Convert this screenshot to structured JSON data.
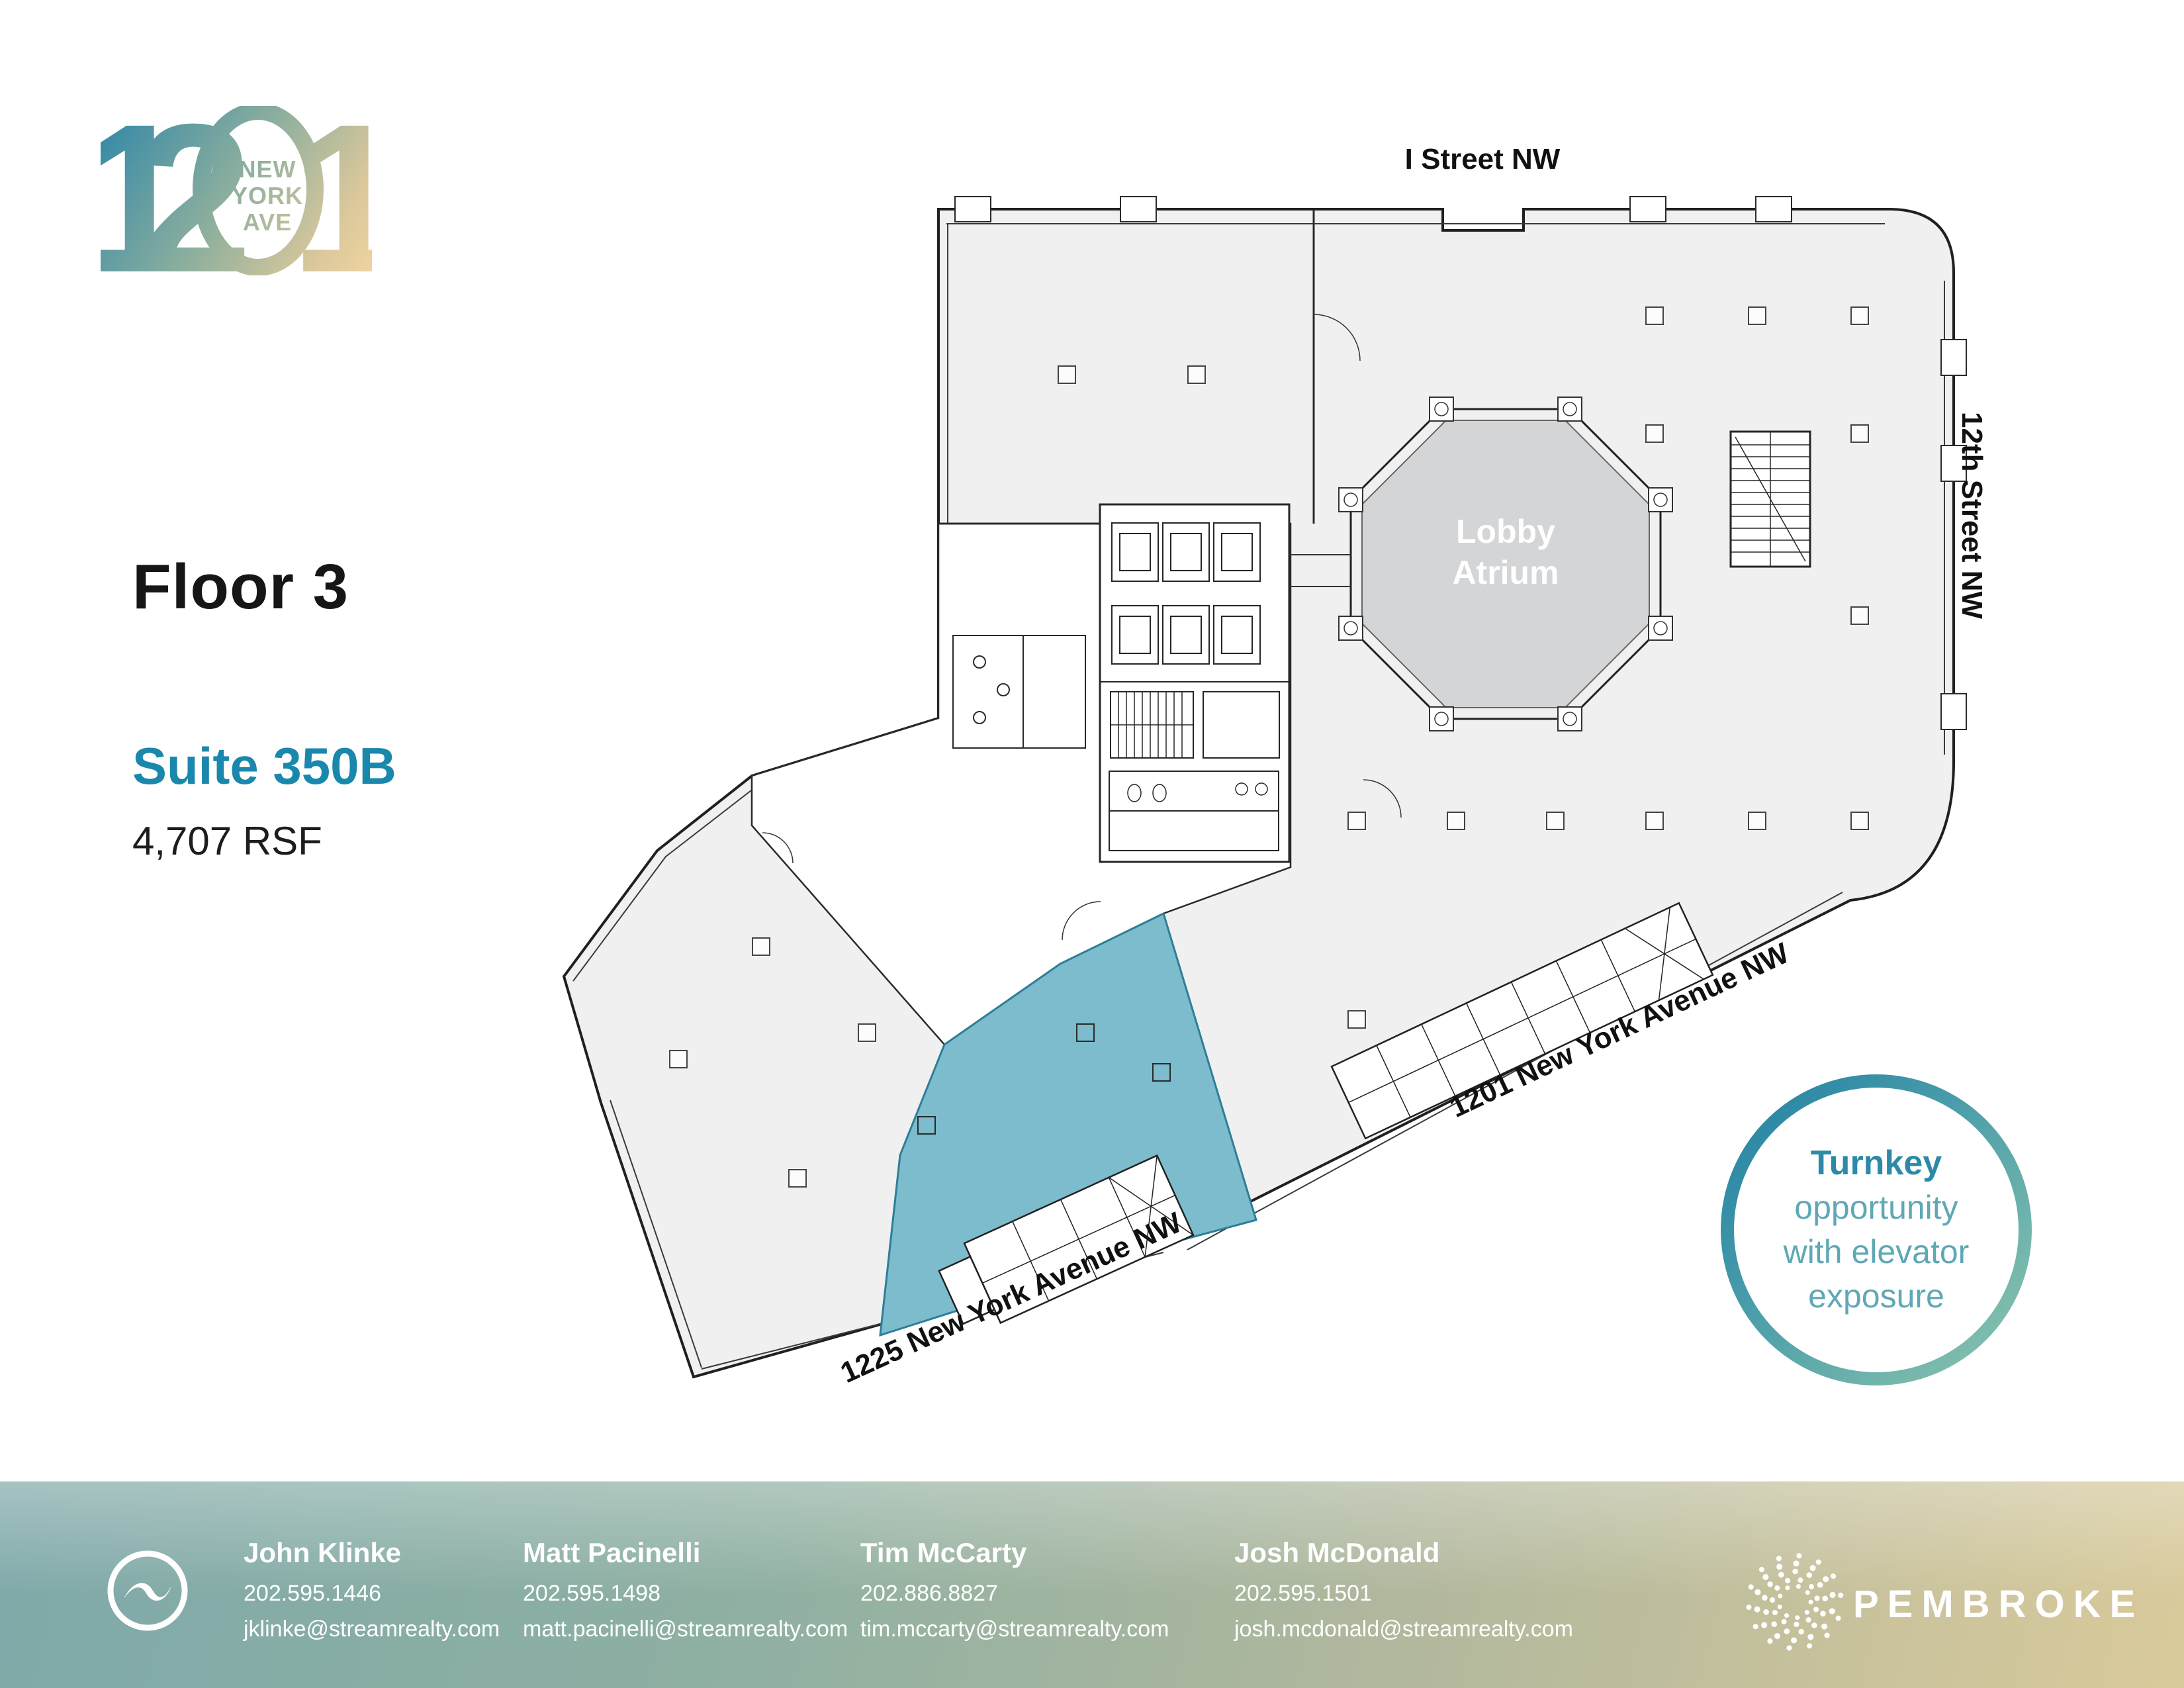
{
  "logo": {
    "digit_1a": "1",
    "digit_2": "2",
    "digit_1b": "1",
    "inner_line1": "NEW",
    "inner_line2": "YORK",
    "inner_line3": "AVE"
  },
  "left_panel": {
    "floor_title": "Floor 3",
    "suite_label": "Suite 350B",
    "area_label": "4,707 RSF"
  },
  "plan": {
    "street_top": "I Street NW",
    "street_right": "12th Street NW",
    "avenue_main": "1201 New York Avenue NW",
    "avenue_secondary": "1225 New York Avenue NW",
    "atrium_line1": "Lobby",
    "atrium_line2": "Atrium"
  },
  "badge": {
    "line1": "Turnkey",
    "line2": "opportunity",
    "line3": "with elevator",
    "line4": "exposure"
  },
  "footer": {
    "contacts": [
      {
        "name": "John Klinke",
        "phone": "202.595.1446",
        "email": "jklinke@streamrealty.com"
      },
      {
        "name": "Matt Pacinelli",
        "phone": "202.595.1498",
        "email": "matt.pacinelli@streamrealty.com"
      },
      {
        "name": "Tim McCarty",
        "phone": "202.886.8827",
        "email": "tim.mccarty@streamrealty.com"
      },
      {
        "name": "Josh McDonald",
        "phone": "202.595.1501",
        "email": "josh.mcdonald@streamrealty.com"
      }
    ],
    "brand": "PEMBROKE"
  },
  "colors": {
    "suite_highlight": "#7cbccd",
    "suite_outline": "#2d7e98",
    "suite_text_accent": "#1a87ac",
    "atrium_fill": "#d3d5d7",
    "plan_fill": "#f0f0f1",
    "badge_ring_start": "#1f7fa3",
    "badge_ring_end": "#8fc7ae",
    "footer_teal": "#7fa9a9",
    "footer_sand": "#d9ca9b"
  }
}
